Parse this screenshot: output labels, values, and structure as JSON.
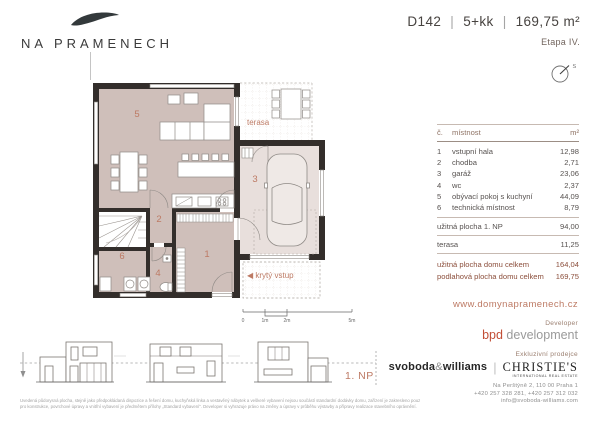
{
  "brand": {
    "name": "NA PRAMENECH"
  },
  "header": {
    "unit_id": "D142",
    "separator": "|",
    "layout": "5+kk",
    "area": "169,75 m²",
    "stage": "Etapa IV.",
    "compass_label": "S"
  },
  "plan": {
    "rooms": {
      "r1": "1",
      "r2": "2",
      "r3": "3",
      "r4": "4",
      "r5": "5",
      "r6": "6"
    },
    "labels": {
      "terasa": "terasa",
      "kryty_vstup": "◀ krytý vstup",
      "floor": "1. NP"
    },
    "scale": {
      "t0": "0",
      "t1": "1m",
      "t2": "2m",
      "t5": "5m"
    }
  },
  "table": {
    "headers": {
      "num": "č.",
      "name": "místnost",
      "unit": "m²"
    },
    "rooms": [
      {
        "num": "1",
        "name": "vstupní hala",
        "area": "12,98"
      },
      {
        "num": "2",
        "name": "chodba",
        "area": "2,71"
      },
      {
        "num": "3",
        "name": "garáž",
        "area": "23,06"
      },
      {
        "num": "4",
        "name": "wc",
        "area": "2,37"
      },
      {
        "num": "5",
        "name": "obývací pokoj s kuchyní",
        "area": "44,09"
      },
      {
        "num": "6",
        "name": "technická místnost",
        "area": "8,79"
      }
    ],
    "subtotal": {
      "name": "užitná plocha 1. NP",
      "area": "94,00"
    },
    "terrace": {
      "name": "terasa",
      "area": "11,25"
    },
    "totals": [
      {
        "name": "užitná plocha domu celkem",
        "area": "164,04"
      },
      {
        "name": "podlahová plocha domu celkem",
        "area": "169,75"
      }
    ]
  },
  "footer": {
    "website": "www.domynapramenech.cz",
    "developer_label": "Developer",
    "developer_primary": "bpd",
    "developer_secondary": " development",
    "broker_label": "Exkluzivní prodejce",
    "broker1_a": "svoboda",
    "broker1_amp": "&",
    "broker1_b": "williams",
    "broker2": "CHRISTIE'S",
    "broker2_sub": "INTERNATIONAL REAL ESTATE",
    "address": "Na Perštýně 2, 110 00 Praha 1",
    "phones": "+420 257 328 281, +420 257 312 032",
    "email": "info@svoboda-williams.com",
    "disclaimer_line1": "Uvedená půdorysná plocha, stejně jako předpokládaná dispozice a řešení domu, kuchyňská linka a vestavěný nábytek a veškeré vybavení nejsou součástí standardní dodávky domu, zařízení je zakresleno pouze pro informaci. Specifikace",
    "disclaimer_line2": "pro konstrukce, povrchové úpravy a vnitřní vybavení je předmětem přílohy „Standard vybavení“. Developer si vyhrazuje právo na změny a úpravy v průběhu výstavby a přípravy realizace stavebního oprávnění."
  },
  "colors": {
    "accent": "#bd7a64",
    "wall": "#332e2b",
    "room_fill": "#cfbfba",
    "garage_fill": "#e8dfdc",
    "total_text": "#8c4f3c",
    "bpd_red": "#c24e36"
  }
}
